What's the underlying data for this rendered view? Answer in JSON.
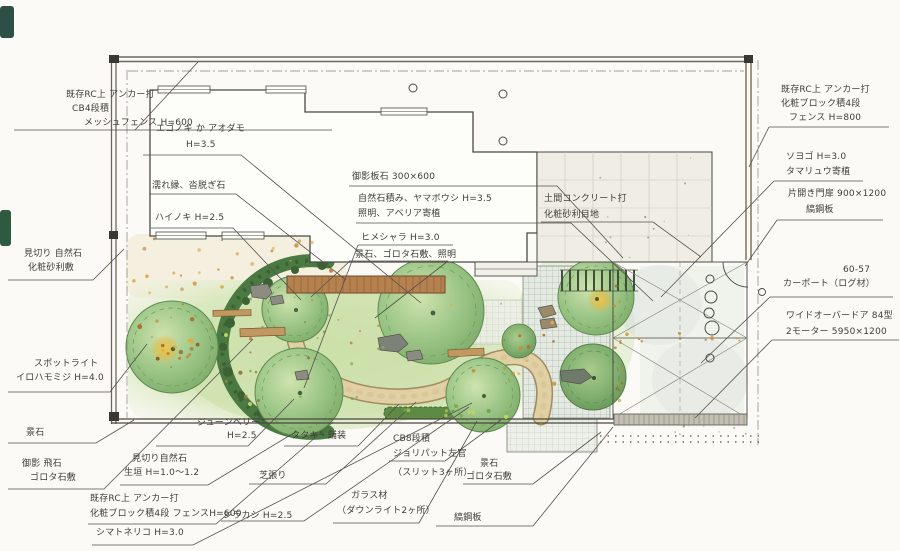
{
  "drawing_type": "hand-drawn residential garden landscape plan (plan view, watercolor sketch)",
  "colors": {
    "paper": "#fbfaf6",
    "ink": "#4a473f",
    "lawn": "#cfe2b0",
    "tree_green": "#8fbf7f",
    "hedge_green": "#47713f",
    "deck_brown": "#b5814f",
    "path_tan": "#dcc89e",
    "gravel_orange": "#c98a35",
    "accent_yellow": "#e9bf4a",
    "wall_brown": "#7a6a50"
  },
  "annotations": {
    "a1": {
      "lines": [
        "既存RC上 アンカー打",
        "CB4段積",
        "メッシュフェンス H=600"
      ]
    },
    "a2": {
      "lines": [
        "見切り 自然石",
        "化粧砂利敷"
      ]
    },
    "a3": {
      "lines": [
        "スポットライト",
        "イロハモミジ H=4.0"
      ]
    },
    "a4": {
      "lines": [
        "景石"
      ]
    },
    "a5": {
      "lines": [
        "御影 飛石",
        "ゴロタ石敷"
      ]
    },
    "b1": {
      "lines": [
        "ジューンベリー",
        "H=2.5"
      ]
    },
    "b2": {
      "lines": [
        "見切り自然石",
        "生垣 H=1.0〜1.2"
      ]
    },
    "b3": {
      "lines": [
        "既存RC上 アンカー打",
        "化粧ブロック積4段 フェンスH=600",
        "シマトネリコ H=3.0"
      ]
    },
    "b4": {
      "lines": [
        "タタキ・舗装"
      ]
    },
    "b5": {
      "lines": [
        "芝張り"
      ]
    },
    "b6": {
      "lines": [
        "シラカシ H=2.5"
      ]
    },
    "b7": {
      "lines": [
        "ガラス材",
        "（ダウンライト2ヶ所）"
      ]
    },
    "b8": {
      "lines": [
        "CB8段積",
        "ジョリパット左官",
        "（スリット3ヶ所）"
      ]
    },
    "b9": {
      "lines": [
        "景石",
        "ゴロタ石敷"
      ]
    },
    "b10": {
      "lines": [
        "縞鋼板"
      ]
    },
    "c1": {
      "lines": [
        "エゴノキ か アオダモ",
        "H=3.5"
      ]
    },
    "c2": {
      "lines": [
        "濡れ縁、沓脱ぎ石"
      ]
    },
    "c3": {
      "lines": [
        "ハイノキ H=2.5"
      ]
    },
    "c4": {
      "lines": [
        "御影板石 300×600"
      ]
    },
    "c5": {
      "lines": [
        "自然石積み、ヤマボウシ H=3.5",
        "照明、アベリア寄植"
      ]
    },
    "c6": {
      "lines": [
        "ヒメシャラ H=3.0"
      ]
    },
    "c7": {
      "lines": [
        "景石、ゴロタ石敷、照明"
      ]
    },
    "c8": {
      "lines": [
        "土間コンクリート打",
        "化粧砂利目地"
      ]
    },
    "r1": {
      "lines": [
        "既存RC上 アンカー打",
        "化粧ブロック積4段",
        "フェンス H=800"
      ]
    },
    "r2": {
      "lines": [
        "ソヨゴ H=3.0",
        "タマリュウ寄植"
      ]
    },
    "r3": {
      "lines": [
        "片開き門扉 900×1200",
        "縞鋼板"
      ]
    },
    "r4": {
      "lines": [
        "60-57",
        "カーポート（ログ材）"
      ]
    },
    "r5": {
      "lines": [
        "ワイドオーバードア 84型",
        "2モーター 5950×1200"
      ]
    }
  }
}
